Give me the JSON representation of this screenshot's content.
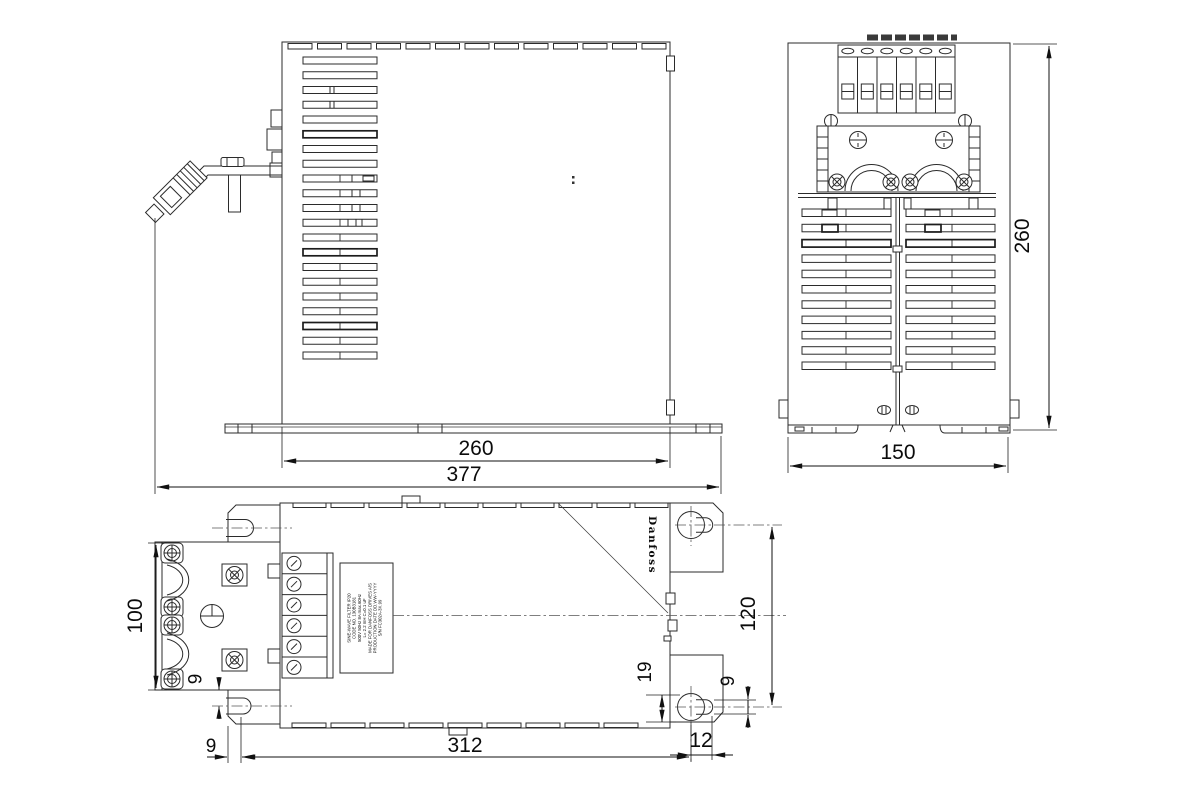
{
  "brand": "Danfoss",
  "colors": {
    "line": "#2b2b2b",
    "dim": "#0b0b0b",
    "background": "#ffffff"
  },
  "views": {
    "side": {
      "name": "side view",
      "dims": {
        "box_width": "260",
        "overall_width": "377"
      }
    },
    "front": {
      "name": "front view",
      "dims": {
        "width": "150",
        "height": "260"
      }
    },
    "top": {
      "name": "top view",
      "dims": {
        "clamp_depth": "100",
        "clamp_to_slot": "9",
        "slot_center_offset": "9",
        "mounting_span": "312",
        "keyhole_span": "120",
        "keyhole_to_edge": "19",
        "keyhole_slot_width": "9",
        "keyhole_slot_length": "12"
      }
    }
  },
  "product_label": {
    "lines": [
      "SINE-WAVE FILTER IP20",
      "CODE NO. 130B3181",
      "500V 50Hz 8A max.60Hz",
      "L= 2.2 mH C=0.1 uF",
      "MADE FOR DANFOSS DRIVES A/S",
      "PRODUCTION DATE DD.WW-YYYY",
      "S/N FC302A-3X.99"
    ]
  }
}
